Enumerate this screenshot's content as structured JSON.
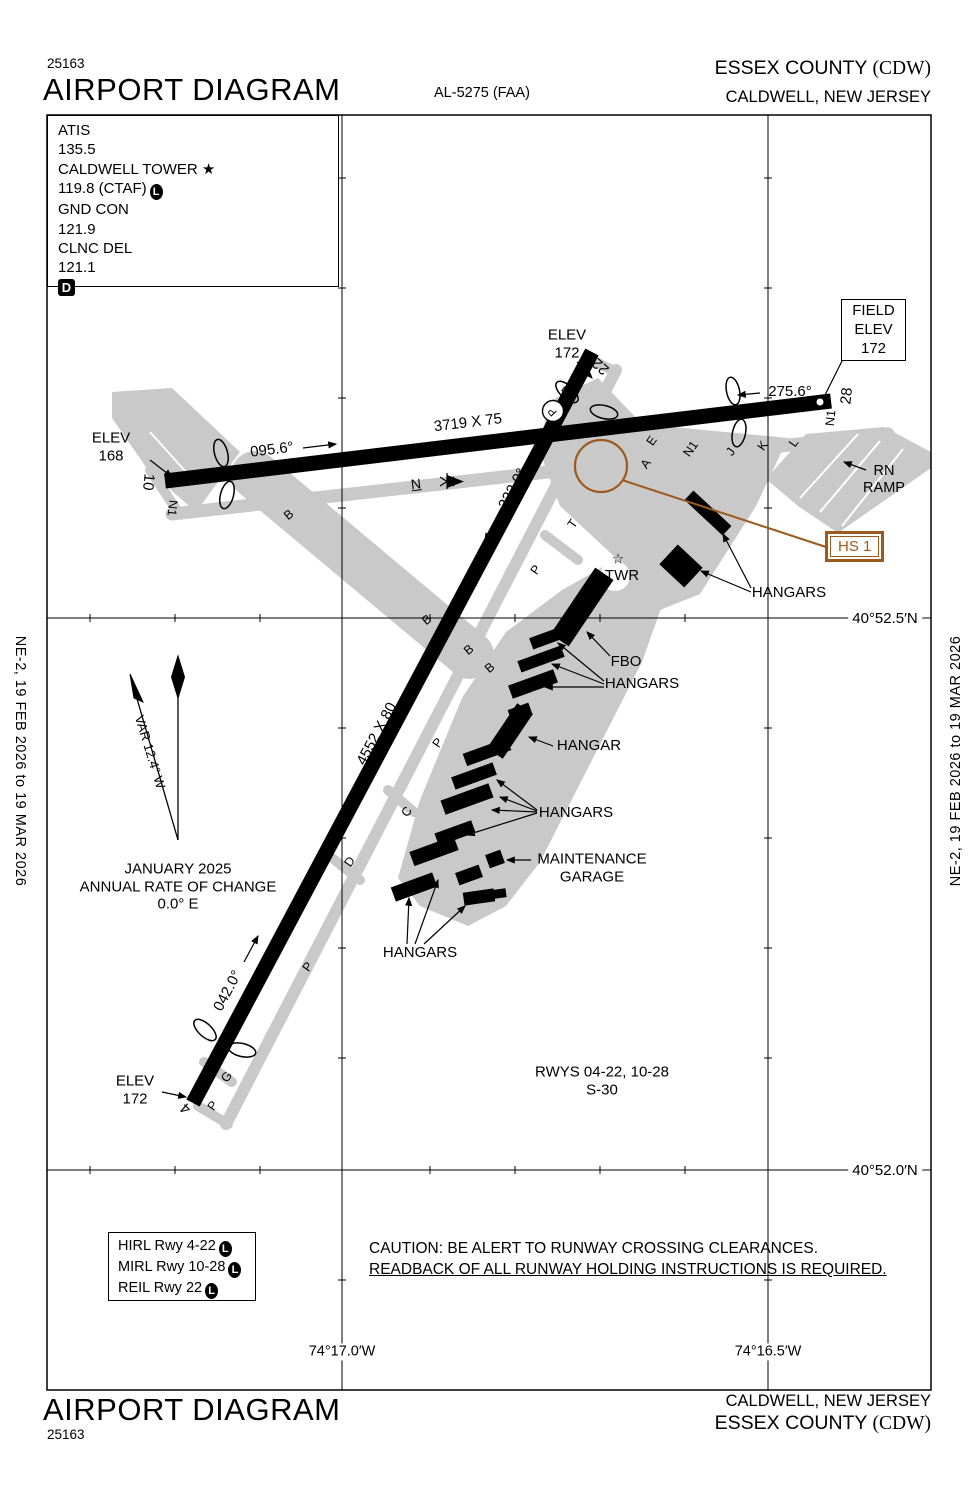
{
  "colors": {
    "pavement": "#c9c9c9",
    "hotspot_brown": "#9c5a1d",
    "ink": "#000000"
  },
  "header": {
    "chart_number": "25163",
    "title": "AIRPORT DIAGRAM",
    "al_number": "AL-5275 (FAA)",
    "airport_name": "ESSEX COUNTY ",
    "airport_code": "(CDW)",
    "city": "CALDWELL, NEW JERSEY"
  },
  "comm_box": {
    "lines": [
      {
        "text": "ATIS"
      },
      {
        "text": "135.5"
      },
      {
        "text": "CALDWELL TOWER ★"
      },
      {
        "text": "119.8 (CTAF)",
        "l_symbol": "L"
      },
      {
        "text": "GND CON"
      },
      {
        "text": "121.9"
      },
      {
        "text": "CLNC DEL"
      },
      {
        "text": "121.1"
      }
    ],
    "d_symbol": "D"
  },
  "field_elev_box": {
    "line1": "FIELD",
    "line2": "ELEV",
    "line3": "172"
  },
  "hotspot": {
    "label": "HS 1"
  },
  "lighting_box": {
    "rows": [
      {
        "text": "HIRL Rwy 4-22",
        "symbol": "L"
      },
      {
        "text": "MIRL Rwy 10-28",
        "symbol": "L"
      },
      {
        "text": "REIL Rwy 22",
        "symbol": "L"
      }
    ]
  },
  "caution": {
    "line1": "CAUTION: BE ALERT TO RUNWAY CROSSING CLEARANCES.",
    "line2": "READBACK OF ALL RUNWAY HOLDING INSTRUCTIONS IS REQUIRED."
  },
  "margins": {
    "edition": "NE-2,  19 FEB 2026  to  19 MAR 2026"
  },
  "footer": {
    "city": "CALDWELL, NEW JERSEY",
    "airport_name": "ESSEX COUNTY ",
    "airport_code": "(CDW)",
    "title": "AIRPORT DIAGRAM",
    "chart_number": "25163"
  },
  "diagram": {
    "runways": [
      {
        "id": "10-28",
        "dimensions": "3719 X 75",
        "headings": [
          "095.6°",
          "275.6°"
        ],
        "numbers": [
          "10",
          "28"
        ]
      },
      {
        "id": "4-22",
        "dimensions": "4552 X 80",
        "headings": [
          "042.0°",
          "222.0°"
        ],
        "numbers": [
          "4",
          "22"
        ]
      }
    ],
    "labels": [
      {
        "n": "elev-168-label",
        "t": "ELEV\n168",
        "x": 111,
        "y": 447,
        "s": 15
      },
      {
        "n": "runway-10-number",
        "t": "10",
        "x": 148,
        "y": 482,
        "r": 96,
        "s": 15
      },
      {
        "n": "taxiway-n1-west-label",
        "t": "N1",
        "x": 172,
        "y": 508,
        "r": 96,
        "s": 12.5
      },
      {
        "n": "heading-095-label",
        "t": "095.6°",
        "x": 272,
        "y": 450,
        "r": -7,
        "s": 15
      },
      {
        "n": "runway-1028-dimensions",
        "t": "3719 X 75",
        "x": 468,
        "y": 423,
        "r": -7,
        "s": 15
      },
      {
        "n": "heading-275-label",
        "t": "275.6°",
        "x": 790,
        "y": 392,
        "s": 15
      },
      {
        "n": "runway-28-number",
        "t": "28",
        "x": 847,
        "y": 396,
        "r": -84,
        "s": 15
      },
      {
        "n": "taxiway-n1-east-label",
        "t": "N1",
        "x": 831,
        "y": 418,
        "r": -84,
        "s": 12.5
      },
      {
        "n": "elev-172-top-label",
        "t": "ELEV\n172",
        "x": 567,
        "y": 344,
        "s": 15
      },
      {
        "n": "runway-22-number",
        "t": "22",
        "x": 601,
        "y": 366,
        "r": 222,
        "s": 15
      },
      {
        "n": "taxiway-p1-label",
        "t": "P",
        "x": 567,
        "y": 391,
        "r": -55,
        "s": 12.5
      },
      {
        "n": "circled-p-label",
        "t": "P",
        "x": 553,
        "y": 411,
        "r": -135,
        "s": 11
      },
      {
        "n": "taxiway-e-label",
        "t": "E",
        "x": 652,
        "y": 441,
        "r": -55,
        "s": 12.5
      },
      {
        "n": "taxiway-a-label",
        "t": "A",
        "x": 646,
        "y": 464,
        "r": -55,
        "s": 12.5
      },
      {
        "n": "taxiway-n1-mid-label",
        "t": "N1",
        "x": 691,
        "y": 449,
        "r": -55,
        "s": 12.5
      },
      {
        "n": "taxiway-j-label",
        "t": "J",
        "x": 731,
        "y": 452,
        "r": -55,
        "s": 12.5
      },
      {
        "n": "taxiway-k-label",
        "t": "K",
        "x": 763,
        "y": 446,
        "r": -55,
        "s": 12.5
      },
      {
        "n": "taxiway-l-label",
        "t": "L",
        "x": 794,
        "y": 443,
        "r": -55,
        "s": 12.5
      },
      {
        "n": "rn-ramp-label",
        "t": "RN\nRAMP",
        "x": 884,
        "y": 480,
        "s": 14.5
      },
      {
        "n": "taxiway-n-label",
        "t": "N",
        "x": 416,
        "y": 484,
        "r": -7,
        "s": 14,
        "u": true
      },
      {
        "n": "taxiway-t-label",
        "t": "T",
        "x": 573,
        "y": 524,
        "r": -55,
        "s": 12.5
      },
      {
        "n": "taxiway-p2-label",
        "t": "P",
        "x": 536,
        "y": 570,
        "r": -55,
        "s": 12.5
      },
      {
        "n": "heading-222-label",
        "t": "222.0°",
        "x": 513,
        "y": 489,
        "r": -62,
        "s": 15
      },
      {
        "n": "taxiway-b1-label",
        "t": "B",
        "x": 289,
        "y": 515,
        "r": -40,
        "s": 12.5
      },
      {
        "n": "taxiway-b2-label",
        "t": "B",
        "x": 427,
        "y": 620,
        "r": -40,
        "s": 12.5
      },
      {
        "n": "taxiway-b3-label",
        "t": "B",
        "x": 469,
        "y": 650,
        "r": -40,
        "s": 12.5
      },
      {
        "n": "taxiway-b4-label",
        "t": "B",
        "x": 490,
        "y": 668,
        "r": -40,
        "s": 12.5
      },
      {
        "n": "tower-star-icon",
        "t": "☆",
        "x": 618,
        "y": 559,
        "s": 14
      },
      {
        "n": "tower-label",
        "t": "TWR",
        "x": 622,
        "y": 576,
        "s": 15
      },
      {
        "n": "hangars-ne-label",
        "t": "HANGARS",
        "x": 789,
        "y": 593,
        "s": 15
      },
      {
        "n": "fbo-label",
        "t": "FBO",
        "x": 626,
        "y": 662,
        "s": 15
      },
      {
        "n": "hangars-fbo-row-label",
        "t": "HANGARS",
        "x": 642,
        "y": 684,
        "s": 15
      },
      {
        "n": "hangar-label",
        "t": "HANGAR",
        "x": 589,
        "y": 746,
        "s": 15
      },
      {
        "n": "hangars-mid-label",
        "t": "HANGARS",
        "x": 576,
        "y": 813,
        "s": 15
      },
      {
        "n": "maintenance-garage-label",
        "t": "MAINTENANCE\nGARAGE",
        "x": 592,
        "y": 868,
        "s": 15
      },
      {
        "n": "hangars-sw-label",
        "t": "HANGARS",
        "x": 420,
        "y": 953,
        "s": 15
      },
      {
        "n": "runway-0422-dimensions",
        "t": "4552 X 80",
        "x": 377,
        "y": 734,
        "r": -62,
        "s": 15
      },
      {
        "n": "taxiway-p3-label",
        "t": "P",
        "x": 438,
        "y": 743,
        "r": -55,
        "s": 12.5
      },
      {
        "n": "taxiway-c-label",
        "t": "C",
        "x": 407,
        "y": 812,
        "r": -55,
        "s": 12.5
      },
      {
        "n": "taxiway-d-label",
        "t": "D",
        "x": 350,
        "y": 862,
        "r": -55,
        "s": 12.5
      },
      {
        "n": "heading-042-label",
        "t": "042.0°",
        "x": 228,
        "y": 991,
        "r": -62,
        "s": 15
      },
      {
        "n": "taxiway-p4-label",
        "t": "P",
        "x": 308,
        "y": 967,
        "r": -55,
        "s": 12.5
      },
      {
        "n": "taxiway-g-label",
        "t": "G",
        "x": 227,
        "y": 1077,
        "r": -55,
        "s": 12.5
      },
      {
        "n": "taxiway-p5-label",
        "t": "P",
        "x": 213,
        "y": 1106,
        "r": -55,
        "s": 12.5
      },
      {
        "n": "runway-4-number",
        "t": "4",
        "x": 186,
        "y": 1108,
        "r": 222,
        "s": 15
      },
      {
        "n": "elev-172-bottom-label",
        "t": "ELEV\n172",
        "x": 135,
        "y": 1090,
        "s": 15
      },
      {
        "n": "variation-label",
        "t": "VAR 12.4° W",
        "x": 150,
        "y": 752,
        "r": 73,
        "s": 13
      },
      {
        "n": "magnetic-variation-note",
        "t": "JANUARY 2025\nANNUAL RATE OF CHANGE\n0.0° E",
        "x": 178,
        "y": 887,
        "s": 15
      },
      {
        "n": "runway-strength-note",
        "t": "RWYS 04-22, 10-28\nS-30",
        "x": 602,
        "y": 1081,
        "s": 15
      },
      {
        "n": "latitude-label-52-5",
        "t": "40°52.5′N",
        "x": 885,
        "y": 619,
        "s": 15,
        "bg": true
      },
      {
        "n": "latitude-label-52-0",
        "t": "40°52.0′N",
        "x": 885,
        "y": 1171,
        "s": 15,
        "bg": true
      },
      {
        "n": "longitude-label-17-0",
        "t": "74°17.0′W",
        "x": 342,
        "y": 1352,
        "s": 14.5,
        "bg": true
      },
      {
        "n": "longitude-label-16-5",
        "t": "74°16.5′W",
        "x": 768,
        "y": 1352,
        "s": 14.5,
        "bg": true
      }
    ]
  }
}
